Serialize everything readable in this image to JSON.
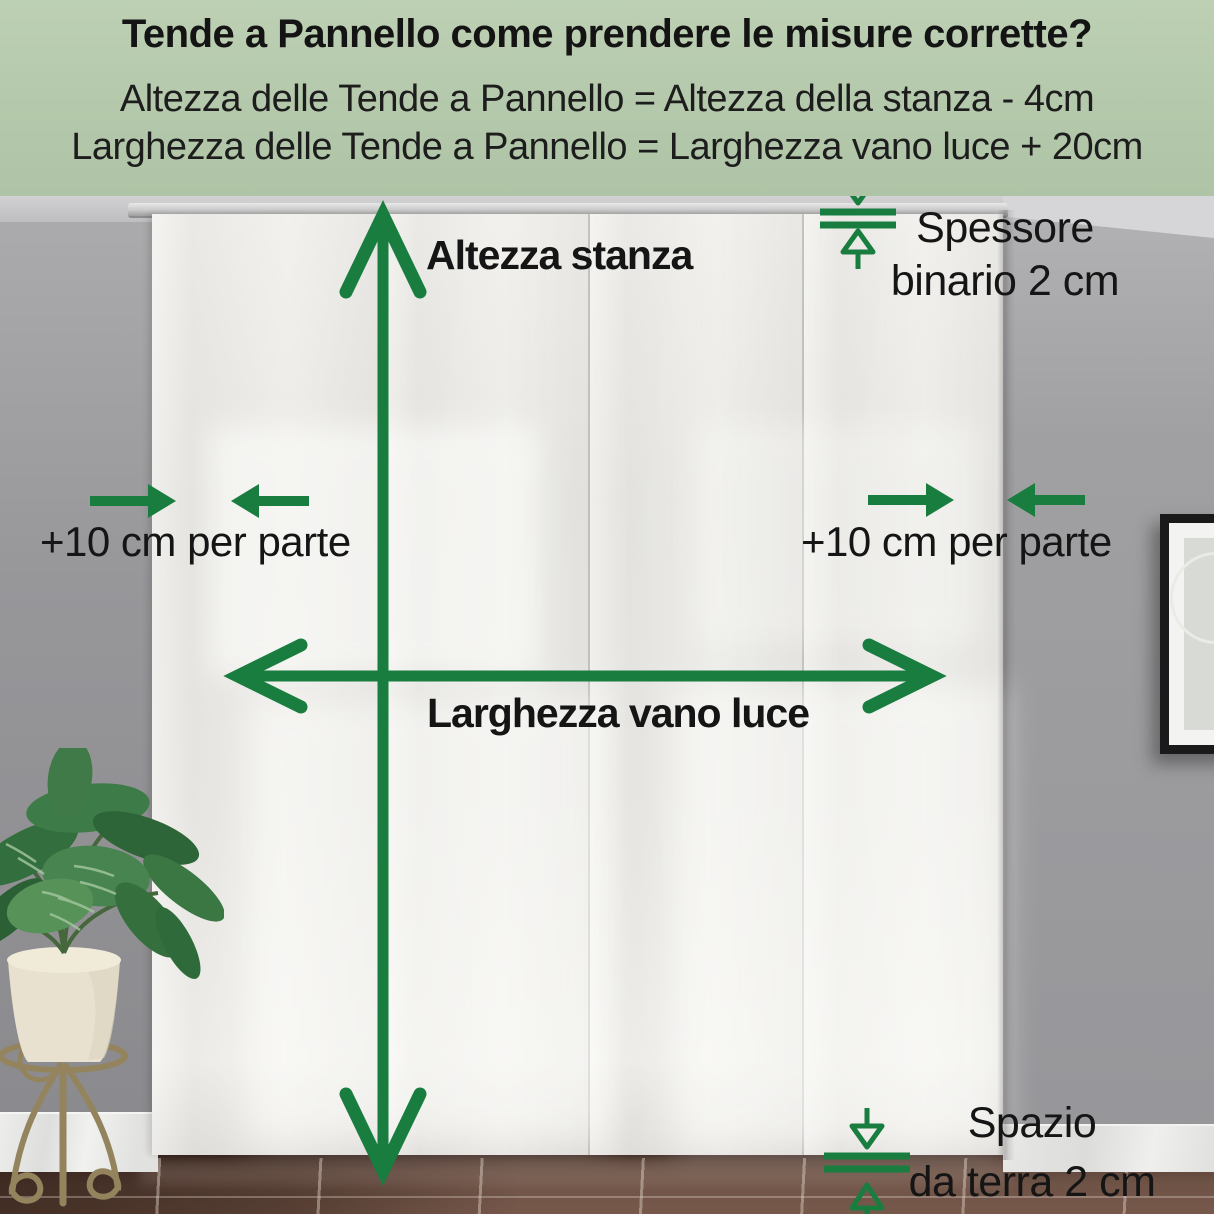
{
  "colors": {
    "accent_green": "#1a7d40",
    "header_background": "#b4c8ab",
    "text_dark": "#151515",
    "wall_gray": "#98989a",
    "curtain_ivory": "#efeeea",
    "floor_brown": "#6f5347",
    "baseboard_marble": "#ececea"
  },
  "header": {
    "title": "Tende a Pannello come prendere le misure corrette?",
    "formula_height": "Altezza delle Tende a Pannello = Altezza della stanza - 4cm",
    "formula_width": "Larghezza delle Tende a Pannello = Larghezza vano luce + 20cm"
  },
  "annotations": {
    "room_height": "Altezza stanza",
    "opening_width": "Larghezza vano luce",
    "track_thickness": [
      "Spessore",
      "binario 2 cm"
    ],
    "side_allowance_left": "+10 cm per parte",
    "side_allowance_right": "+10 cm per parte",
    "floor_gap": [
      "Spazio",
      "da terra 2 cm"
    ]
  }
}
